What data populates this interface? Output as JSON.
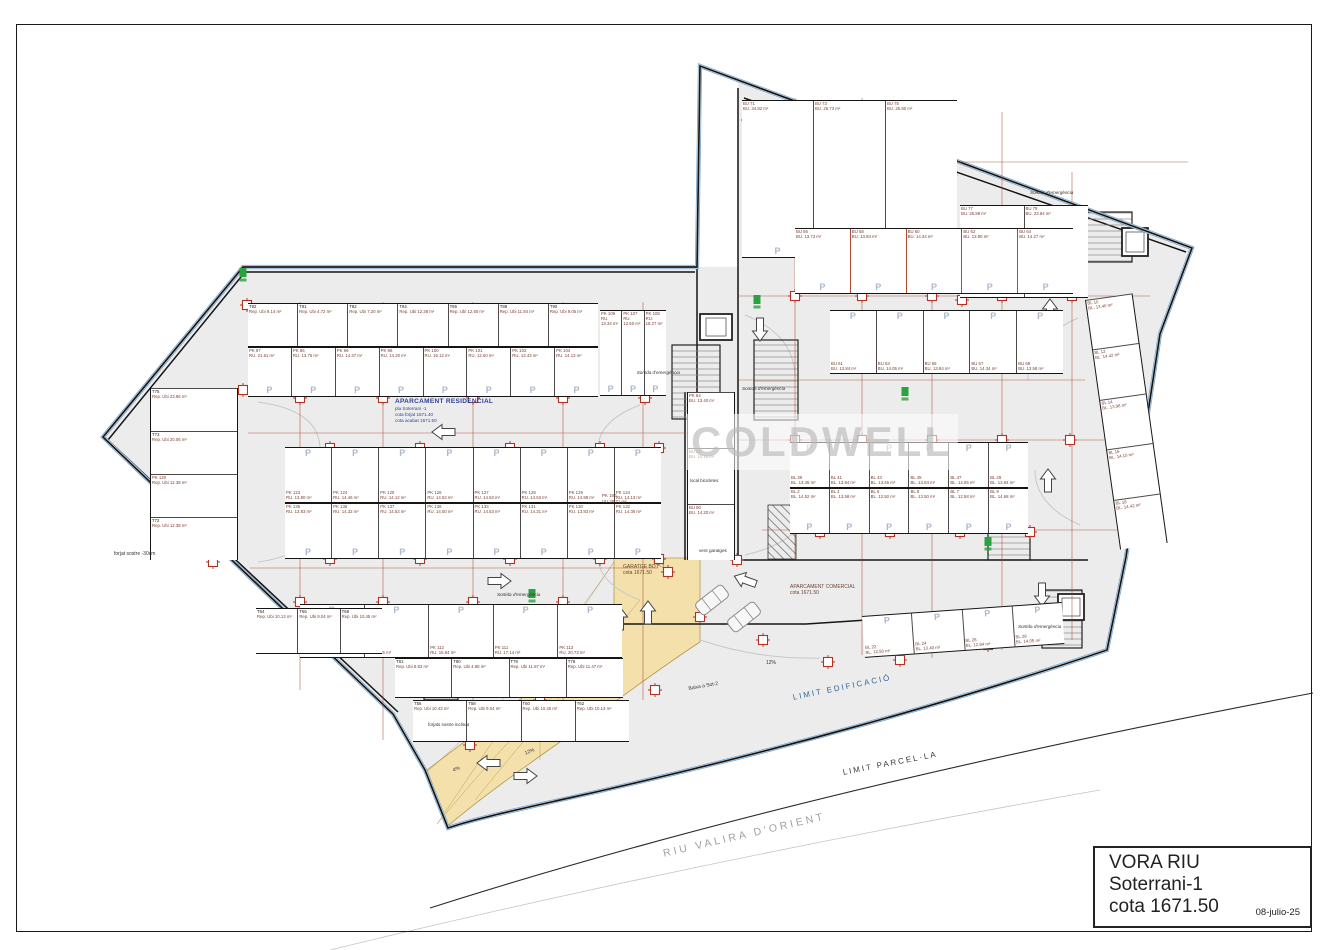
{
  "title_block": {
    "project": "VORA RIU",
    "level": "Soterrani-1",
    "cota": "cota 1671.50",
    "date": "08-julio-25"
  },
  "watermark": "COLDWELL",
  "labels": {
    "residencial_title": "APARCAMENT RESIDENCIAL",
    "residencial_l1": "pla Soterrani -1",
    "residencial_l2": "cota forjat 1671.40",
    "residencial_l3": "cota acabat 1671.50",
    "comercial_title": "APARCAMENT COMERCIAL",
    "comercial_l1": "cota 1671.50",
    "garatge_title": "GARATGE BOT -1",
    "garatge_l1": "cota 1671.50",
    "vent": "vent garatges",
    "bicis": "local bicicletes",
    "forjat30": "forjat sostre -30cm",
    "forjat_incl": "forjats sostre inclinat",
    "baixa": "Baixa a Sot-2",
    "slope12": "12%",
    "slope4": "4%",
    "sortida": "Sortida d'emergència",
    "limit_edificacio": "LIMIT EDIFICACIÓ",
    "limit_parcella": "LIMIT PARCEL·LA",
    "riu": "RIU VALIRA D'ORIENT",
    "pk180_id": "PK 180",
    "pk180_area": "VU 28,71 m²"
  },
  "colors": {
    "boundary_blue": "#7fa8cc",
    "wall_black": "#151515",
    "dim_red": "#a8442c",
    "ramp_yellow": "#f3e0aa",
    "exit_green": "#2aa23f",
    "p_letter": "#adb8c9",
    "fill_gray": "#ececec"
  },
  "plan": {
    "strips": [
      {
        "name": "trasters-top",
        "x": 248,
        "y": 303,
        "w": 350,
        "h": 44,
        "sub": "Rep. Ubi",
        "p": null,
        "cells": [
          [
            "T92",
            "9.14 m²"
          ],
          [
            "T91",
            "4.72 m²"
          ],
          [
            "T82",
            "7.20 m²"
          ],
          [
            "T84",
            "12.38 m²"
          ],
          [
            "T86",
            "12.60 m²"
          ],
          [
            "T88",
            "11.84 m²"
          ],
          [
            "T90",
            "9.05 m²"
          ]
        ]
      },
      {
        "name": "stalls-top",
        "x": 248,
        "y": 347,
        "w": 350,
        "h": 50,
        "sub": "RU.",
        "p": "bottom",
        "cells": [
          [
            "PK 87",
            "21.61 m²"
          ],
          [
            "PK 86",
            "13.76 m²"
          ],
          [
            "PK 96",
            "14.37 m²"
          ],
          [
            "PK 98",
            "14.20 m²"
          ],
          [
            "PK 100",
            "16.12 m²"
          ],
          [
            "PK 101",
            "12.60 m²"
          ],
          [
            "PK 102",
            "13.43 m²"
          ],
          [
            "PK 104",
            "14.13 m²"
          ]
        ]
      },
      {
        "name": "stalls-106",
        "x": 600,
        "y": 310,
        "w": 66,
        "h": 86,
        "sub": "RU.",
        "p": "bottom",
        "cells": [
          [
            "PK 106",
            "13.34 m²"
          ],
          [
            "PK 107",
            "12.50 m²"
          ],
          [
            "PK 108",
            "18.27 m²"
          ]
        ]
      },
      {
        "name": "mid-row-upper",
        "x": 285,
        "y": 447,
        "w": 376,
        "h": 56,
        "sub": "RU.",
        "p": "top",
        "cells": [
          [
            "PK 123",
            "13.80 m²"
          ],
          [
            "PK 124",
            "14.46 m²"
          ],
          [
            "PK 125",
            "14.12 m²"
          ],
          [
            "PK 126",
            "14.52 m²"
          ],
          [
            "PK 127",
            "14.53 m²"
          ],
          [
            "PK 128",
            "14.53 m²"
          ],
          [
            "PK 129",
            "14.98 m²"
          ],
          [
            "PK 134",
            "14.13 m²"
          ]
        ]
      },
      {
        "name": "mid-row-lower",
        "x": 285,
        "y": 503,
        "w": 376,
        "h": 56,
        "sub": "RU.",
        "p": "bottom",
        "cells": [
          [
            "PK 135",
            "13.83 m²"
          ],
          [
            "PK 136",
            "14.32 m²"
          ],
          [
            "PK 137",
            "14.53 m²"
          ],
          [
            "PK 138",
            "14.50 m²"
          ],
          [
            "PK 133",
            "14.53 m²"
          ],
          [
            "PK 131",
            "14.31 m²"
          ],
          [
            "PK 130",
            "13.83 m²"
          ],
          [
            "PK 132",
            "14.36 m²"
          ]
        ]
      },
      {
        "name": "bottom-stalls",
        "x": 300,
        "y": 604,
        "w": 322,
        "h": 54,
        "sub": "RU.",
        "p": "top",
        "cells": [
          [
            "PK 109",
            "13.98 m²"
          ],
          [
            "PK 110",
            "15.25 m²"
          ],
          [
            "PK 112",
            "16.84 m²"
          ],
          [
            "PK 111",
            "17.14 m²"
          ],
          [
            "PK 113",
            "20.73 m²"
          ]
        ]
      },
      {
        "name": "bottom-trasters-1",
        "x": 395,
        "y": 658,
        "w": 228,
        "h": 40,
        "sub": "Rep. Ubi",
        "p": null,
        "cells": [
          [
            "T81",
            "8.83 m²"
          ],
          [
            "T80",
            "4.88 m²"
          ],
          [
            "T79",
            "11.87 m²"
          ],
          [
            "T78",
            "11.47 m²"
          ]
        ]
      },
      {
        "name": "bottom-trasters-2",
        "x": 413,
        "y": 700,
        "w": 216,
        "h": 42,
        "sub": "Rep. Ubi",
        "p": null,
        "cells": [
          [
            "T56",
            "10.43 m²"
          ],
          [
            "T58",
            "9.04 m²"
          ],
          [
            "T60",
            "10.45 m²"
          ],
          [
            "T62",
            "10.13 m²"
          ]
        ]
      },
      {
        "name": "bottom-trasters-3",
        "x": 256,
        "y": 608,
        "w": 126,
        "h": 46,
        "sub": "Rep. Ubi",
        "p": null,
        "cells": [
          [
            "T64",
            "10.13 m²"
          ],
          [
            "T66",
            "9.04 m²"
          ],
          [
            "T68",
            "10.45 m²"
          ]
        ]
      },
      {
        "name": "left-column",
        "x": 150,
        "y": 388,
        "w": 88,
        "h": 172,
        "sub": "Rep. Ubi",
        "p": null,
        "vert": true,
        "cells": [
          [
            "T75",
            "23.86 m²"
          ],
          [
            "T73",
            "20.06 m²"
          ],
          [
            "PK 120",
            "12.38 m²"
          ],
          [
            "T72",
            "12.38 m²"
          ]
        ]
      },
      {
        "name": "corridor-rooms",
        "x": 687,
        "y": 392,
        "w": 48,
        "h": 168,
        "sub": "BU.",
        "p": null,
        "vert": true,
        "cells": [
          [
            "PK 84",
            "13.40 m²"
          ],
          [
            "BU 82",
            "15.10 m²"
          ],
          [
            "BU 80",
            "14.20 m²"
          ]
        ]
      },
      {
        "name": "com-top-block",
        "x": 742,
        "y": 100,
        "w": 215,
        "h": 158,
        "sub": "BU.",
        "p": "bottom",
        "cells": [
          [
            "BU 71",
            "34.82 m²"
          ],
          [
            "BU 73",
            "25.73 m²"
          ],
          [
            "BU 75",
            "25.80 m²"
          ]
        ]
      },
      {
        "name": "com-top-block-2",
        "x": 960,
        "y": 205,
        "w": 128,
        "h": 93,
        "sub": "BU.",
        "p": "bottom",
        "cells": [
          [
            "BU 77",
            "25.88 m²"
          ],
          [
            "BU 79",
            "23.84 m²"
          ]
        ]
      },
      {
        "name": "com-row-1",
        "x": 795,
        "y": 228,
        "w": 278,
        "h": 66,
        "sub": "BU.",
        "p": "bottom",
        "red": true,
        "cells": [
          [
            "BU 56",
            "13.73 m²"
          ],
          [
            "BU 58",
            "13.84 m²"
          ],
          [
            "BU 60",
            "14.34 m²"
          ],
          [
            "BU 62",
            "13.90 m²"
          ],
          [
            "BU 64",
            "14.27 m²"
          ]
        ]
      },
      {
        "name": "com-row-2",
        "x": 830,
        "y": 310,
        "w": 233,
        "h": 64,
        "sub": "BU.",
        "p": "top",
        "cells": [
          [
            "BU 61",
            "13.84 m²"
          ],
          [
            "BU 63",
            "14.05 m²"
          ],
          [
            "BU 65",
            "13.84 m²"
          ],
          [
            "BU 67",
            "14.34 m²"
          ],
          [
            "BU 69",
            "13.58 m²"
          ]
        ]
      },
      {
        "name": "com-mid-upper",
        "x": 790,
        "y": 442,
        "w": 238,
        "h": 46,
        "sub": "BL.",
        "p": "top",
        "cells": [
          [
            "BL 39",
            "13.45 m²"
          ],
          [
            "BL 41",
            "13.84 m²"
          ],
          [
            "BL 43",
            "13.46 m²"
          ],
          [
            "BL 45",
            "13.84 m²"
          ],
          [
            "BL 47",
            "14.05 m²"
          ],
          [
            "BL 49",
            "13.84 m²"
          ]
        ]
      },
      {
        "name": "com-mid-lower",
        "x": 790,
        "y": 488,
        "w": 238,
        "h": 46,
        "sub": "BL.",
        "p": "bottom",
        "cells": [
          [
            "BL 2",
            "14.52 m²"
          ],
          [
            "BL 4",
            "13.58 m²"
          ],
          [
            "BL 6",
            "12.50 m²"
          ],
          [
            "BL 8",
            "13.50 m²"
          ],
          [
            "BL 7",
            "12.58 m²"
          ],
          [
            "BL 9",
            "14.68 m²"
          ]
        ]
      },
      {
        "name": "com-right-edge",
        "x": 1085,
        "y": 300,
        "w": 48,
        "h": 252,
        "sub": "BL.",
        "p": null,
        "vert": true,
        "rot": -8,
        "cells": [
          [
            "BL 10",
            "13.40 m²"
          ],
          [
            "BL 12",
            "14.42 m²"
          ],
          [
            "BL 14",
            "13.98 m²"
          ],
          [
            "BL 16",
            "14.10 m²"
          ],
          [
            "BL 18",
            "14.42 m²"
          ]
        ]
      },
      {
        "name": "com-bottom-row",
        "x": 862,
        "y": 616,
        "w": 200,
        "h": 42,
        "sub": "BL.",
        "p": "top",
        "rot": -4,
        "cells": [
          [
            "BL 22",
            "12.50 m²"
          ],
          [
            "BL 24",
            "13.40 m²"
          ],
          [
            "BL 26",
            "12.84 m²"
          ],
          [
            "BL 28",
            "14.05 m²"
          ]
        ]
      }
    ],
    "columns": [
      [
        300,
        398
      ],
      [
        383,
        398
      ],
      [
        473,
        398
      ],
      [
        563,
        398
      ],
      [
        645,
        398
      ],
      [
        330,
        448
      ],
      [
        420,
        448
      ],
      [
        510,
        448
      ],
      [
        600,
        448
      ],
      [
        659,
        448
      ],
      [
        330,
        559
      ],
      [
        420,
        559
      ],
      [
        510,
        559
      ],
      [
        600,
        559
      ],
      [
        659,
        559
      ],
      [
        300,
        602
      ],
      [
        383,
        602
      ],
      [
        473,
        602
      ],
      [
        563,
        602
      ],
      [
        423,
        690
      ],
      [
        508,
        690
      ],
      [
        592,
        690
      ],
      [
        655,
        690
      ],
      [
        243,
        390
      ],
      [
        160,
        438
      ],
      [
        213,
        562
      ],
      [
        247,
        305
      ],
      [
        540,
        700
      ],
      [
        614,
        645
      ],
      [
        470,
        745
      ],
      [
        795,
        296
      ],
      [
        862,
        296
      ],
      [
        932,
        296
      ],
      [
        1002,
        296
      ],
      [
        1072,
        296
      ],
      [
        795,
        440
      ],
      [
        862,
        440
      ],
      [
        932,
        440
      ],
      [
        1002,
        440
      ],
      [
        1070,
        440
      ],
      [
        820,
        532
      ],
      [
        890,
        532
      ],
      [
        960,
        532
      ],
      [
        1030,
        532
      ],
      [
        748,
        120
      ],
      [
        795,
        152
      ],
      [
        858,
        162
      ],
      [
        1008,
        258
      ],
      [
        962,
        300
      ],
      [
        836,
        230
      ],
      [
        908,
        230
      ],
      [
        980,
        230
      ],
      [
        700,
        617
      ],
      [
        763,
        640
      ],
      [
        828,
        662
      ],
      [
        900,
        660
      ],
      [
        988,
        645
      ],
      [
        668,
        572
      ],
      [
        737,
        560
      ]
    ],
    "greens": [
      [
        243,
        273
      ],
      [
        470,
        387
      ],
      [
        300,
        490
      ],
      [
        532,
        594
      ],
      [
        527,
        620
      ],
      [
        585,
        620
      ],
      [
        905,
        392
      ],
      [
        1012,
        258
      ],
      [
        988,
        542
      ],
      [
        757,
        300
      ],
      [
        447,
        616
      ],
      [
        550,
        616
      ]
    ],
    "arrows": [
      [
        455,
        432,
        180
      ],
      [
        930,
        212,
        180
      ],
      [
        1050,
        322,
        -90
      ],
      [
        760,
        318,
        90
      ],
      [
        1048,
        492,
        -90
      ],
      [
        1042,
        583,
        90
      ],
      [
        488,
        581,
        0
      ],
      [
        648,
        624,
        -90
      ],
      [
        620,
        630,
        -90
      ],
      [
        500,
        763,
        180
      ],
      [
        514,
        776,
        0
      ],
      [
        756,
        584,
        200
      ]
    ],
    "cars": [
      [
        712,
        600,
        -38
      ],
      [
        744,
        617,
        -38
      ]
    ],
    "dims": [
      [
        248,
        433,
        695,
        433
      ],
      [
        250,
        568,
        658,
        568
      ],
      [
        383,
        302,
        383,
        740
      ],
      [
        473,
        302,
        473,
        742
      ],
      [
        563,
        302,
        563,
        740
      ],
      [
        643,
        302,
        643,
        700
      ],
      [
        300,
        302,
        300,
        690
      ],
      [
        795,
        98,
        795,
        558
      ],
      [
        862,
        98,
        862,
        655
      ],
      [
        932,
        102,
        932,
        658
      ],
      [
        1002,
        112,
        1002,
        650
      ],
      [
        1072,
        172,
        1072,
        640
      ],
      [
        739,
        296,
        1150,
        296
      ],
      [
        739,
        440,
        1148,
        440
      ],
      [
        762,
        530,
        1140,
        530
      ],
      [
        745,
        162,
        1188,
        162
      ],
      [
        739,
        380,
        1085,
        380
      ]
    ]
  }
}
